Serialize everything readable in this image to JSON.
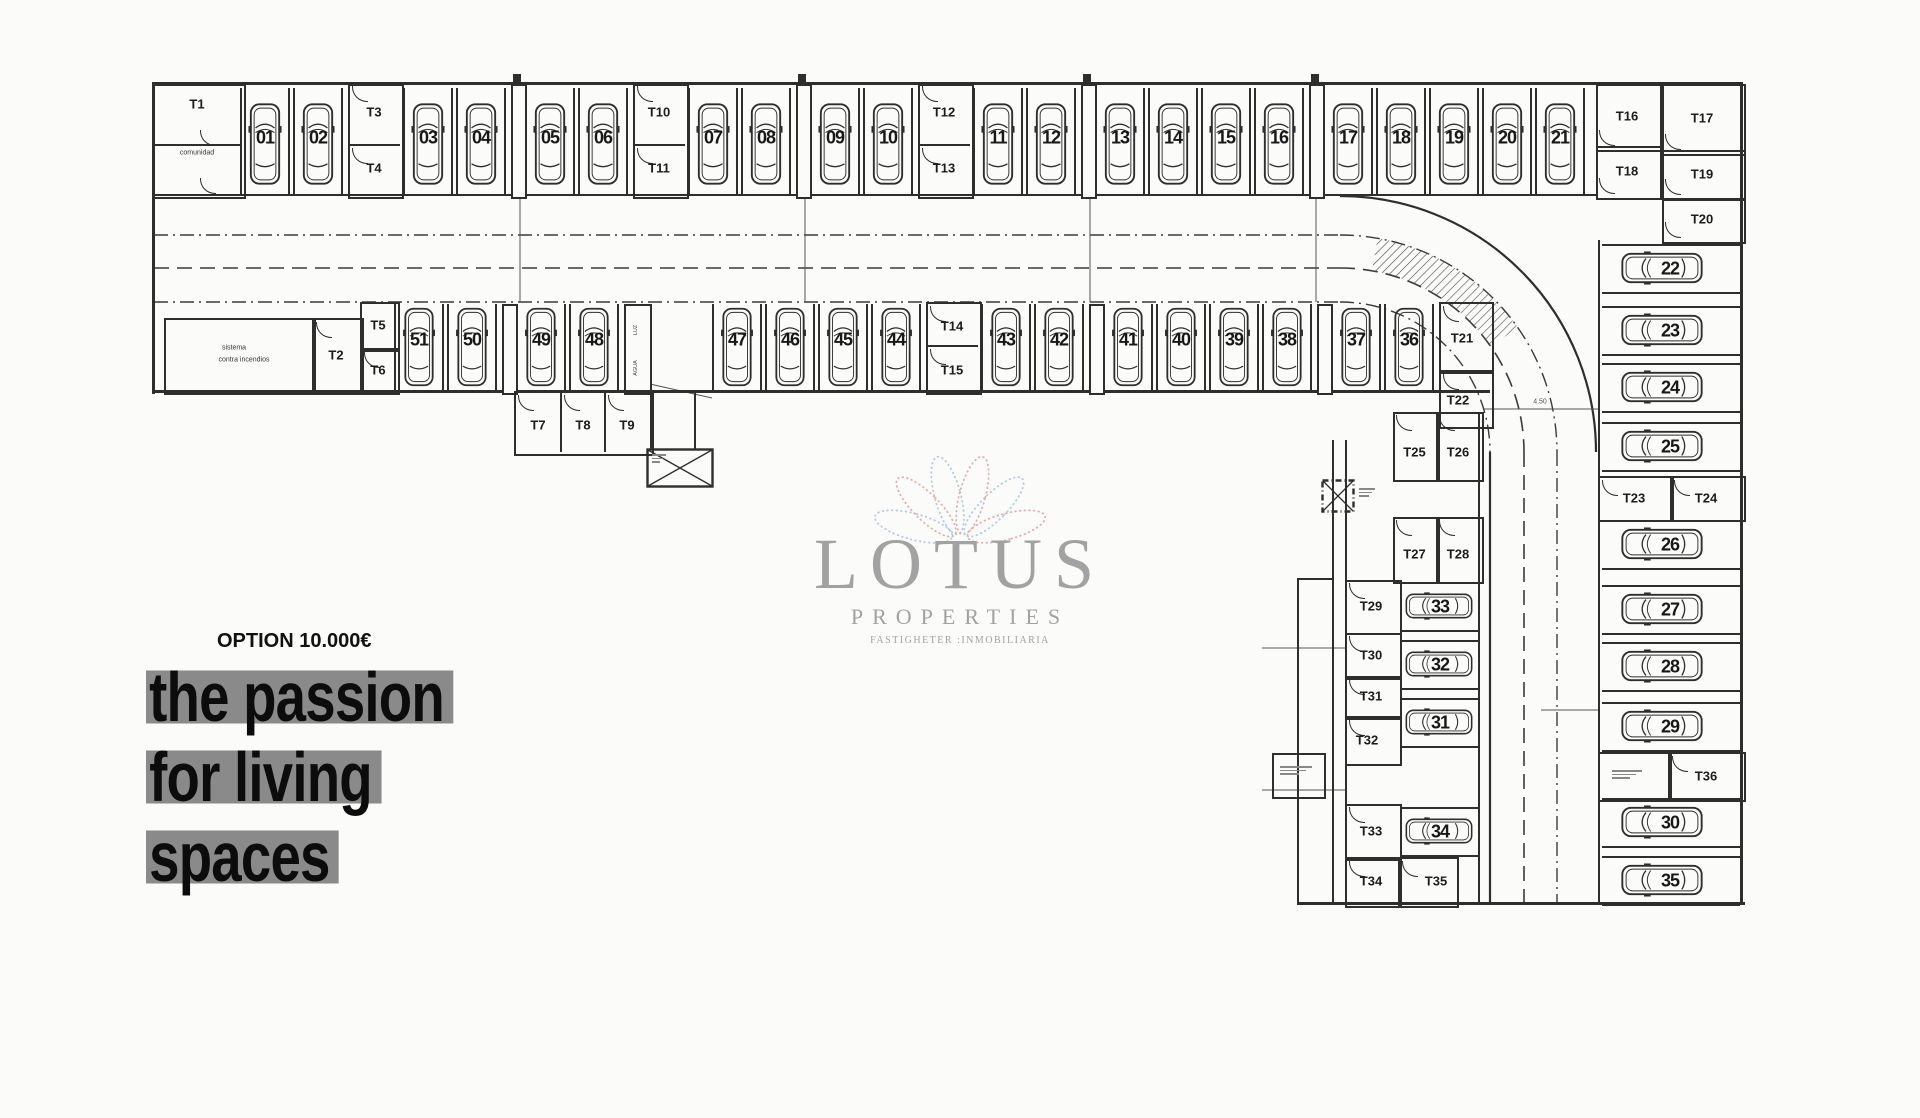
{
  "page": {
    "bg": "#fbfbfa"
  },
  "plan": {
    "ink": "#2e2e2e",
    "road": {
      "dim_label": "4.50"
    },
    "top_row": {
      "entry_room": {
        "label": "T1",
        "sublabel": "comunidad"
      },
      "cells": [
        {
          "kind": "stalls",
          "nums": [
            "01",
            "02"
          ]
        },
        {
          "kind": "tcol",
          "labels": [
            "T3",
            "T4"
          ]
        },
        {
          "kind": "stalls",
          "nums": [
            "03",
            "04"
          ]
        },
        {
          "kind": "wall"
        },
        {
          "kind": "stalls",
          "nums": [
            "05",
            "06"
          ]
        },
        {
          "kind": "tcol",
          "labels": [
            "T10",
            "T11"
          ]
        },
        {
          "kind": "stalls",
          "nums": [
            "07",
            "08"
          ]
        },
        {
          "kind": "wall"
        },
        {
          "kind": "stalls",
          "nums": [
            "09",
            "10"
          ]
        },
        {
          "kind": "tcol",
          "labels": [
            "T12",
            "T13"
          ]
        },
        {
          "kind": "stalls",
          "nums": [
            "11",
            "12"
          ]
        },
        {
          "kind": "wall"
        },
        {
          "kind": "stalls",
          "nums": [
            "13",
            "14",
            "15",
            "16"
          ]
        },
        {
          "kind": "wall"
        },
        {
          "kind": "stalls",
          "nums": [
            "17",
            "18",
            "19"
          ]
        },
        {
          "kind": "stalls",
          "nums": [
            "20",
            "21"
          ]
        }
      ],
      "end_rooms": [
        "T16",
        "T17",
        "T18",
        "T19",
        "T20"
      ]
    },
    "middle_row": {
      "fire_room": [
        "sistema",
        "contra incendios"
      ],
      "rooms": {
        "t2": "T2",
        "t5": "T5",
        "t6": "T6"
      },
      "utility_labels": [
        "LUZ",
        "AGUA"
      ],
      "cells": [
        {
          "kind": "stalls",
          "nums": [
            "51",
            "50"
          ]
        },
        {
          "kind": "wall"
        },
        {
          "kind": "stalls",
          "nums": [
            "49",
            "48"
          ]
        },
        {
          "kind": "utility"
        },
        {
          "kind": "corridor"
        },
        {
          "kind": "stalls",
          "nums": [
            "47",
            "46",
            "45",
            "44"
          ]
        },
        {
          "kind": "tcol",
          "labels": [
            "T14",
            "T15"
          ]
        },
        {
          "kind": "stalls",
          "nums": [
            "43",
            "42"
          ]
        },
        {
          "kind": "wall"
        },
        {
          "kind": "stalls",
          "nums": [
            "41",
            "40",
            "39",
            "38"
          ]
        },
        {
          "kind": "wall"
        },
        {
          "kind": "stalls",
          "nums": [
            "37",
            "36"
          ]
        }
      ],
      "under_rooms": [
        "T7",
        "T8",
        "T9"
      ],
      "corner_rooms": [
        "T21",
        "T22"
      ]
    },
    "right_column": {
      "stalls": [
        "22",
        "23",
        "24",
        "25",
        "26",
        "27",
        "28",
        "29",
        "30",
        "35"
      ],
      "mid_rooms": [
        "T23",
        "T24"
      ],
      "lower_rooms": [
        "T36"
      ]
    },
    "bottom_wing": {
      "rooms": [
        "T25",
        "T26",
        "T27",
        "T28",
        "T29",
        "T30",
        "T31",
        "T32",
        "T33",
        "T34",
        "T35"
      ],
      "stalls": [
        "33",
        "32",
        "31",
        "34"
      ]
    }
  },
  "watermark": {
    "name": "LOTUS",
    "subtitle": "PROPERTIES",
    "tagline": "FASTIGHETER :INMOBILIARIA",
    "petal_blue": "#a5c6e3",
    "petal_red": "#e2a49f",
    "text_color": "#a2a2a2"
  },
  "promo": {
    "option": "OPTION 10.000€",
    "slogan": [
      "the passion",
      "for living",
      "spaces"
    ],
    "highlight": "#8a8a8a",
    "ink": "#0c0c0c"
  }
}
